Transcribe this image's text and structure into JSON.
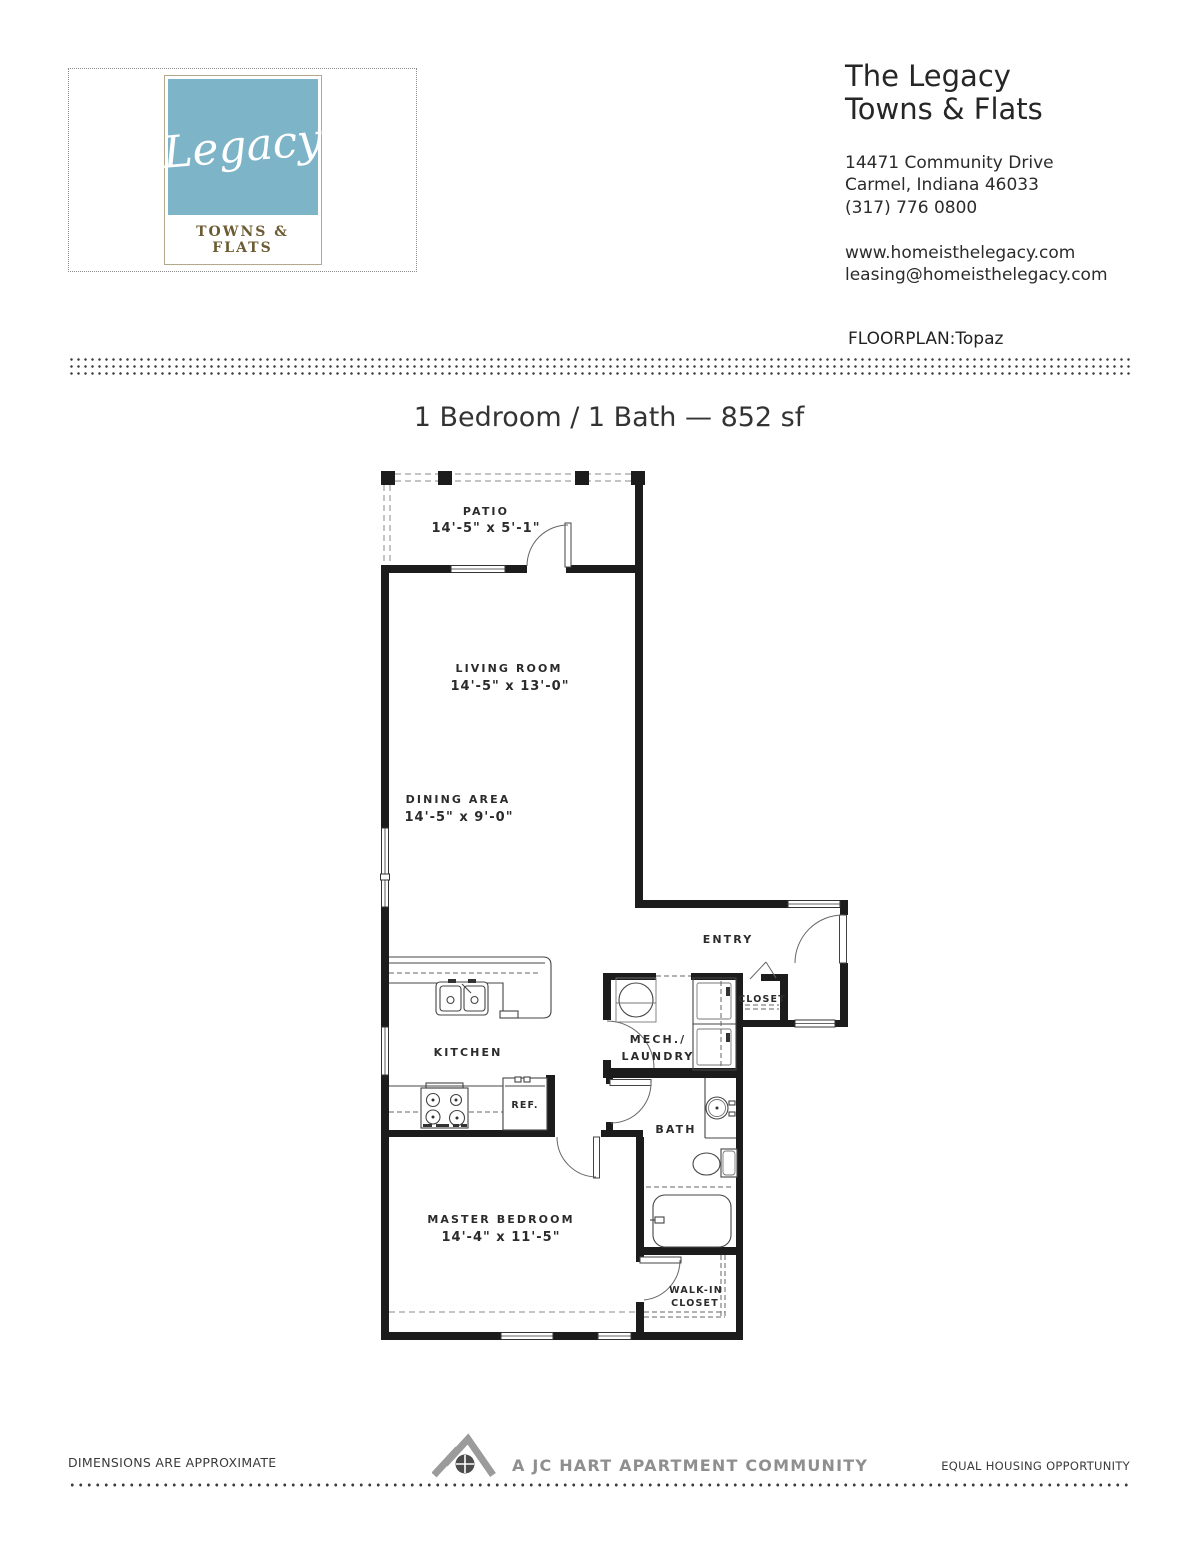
{
  "header": {
    "logo": {
      "script": "Legacy",
      "wordmark": "TOWNS & FLATS",
      "blue": "#7db4c8",
      "brown": "#6d5c33"
    },
    "company_line1": "The Legacy",
    "company_line2": "Towns & Flats",
    "address_line1": "14471 Community Drive",
    "address_line2": "Carmel, Indiana 46033",
    "phone": "(317) 776 0800",
    "website": "www.homeisthelegacy.com",
    "email": "leasing@homeisthelegacy.com",
    "floorplan": "FLOORPLAN:Topaz"
  },
  "plan": {
    "title": "1 Bedroom / 1 Bath — 852 sf",
    "labels": {
      "patio": "PATIO",
      "patio_dims": "14'-5\" x 5'-1\"",
      "living": "LIVING ROOM",
      "living_dims": "14'-5\" x 13'-0\"",
      "dining": "DINING AREA",
      "dining_dims": "14'-5\" x 9'-0\"",
      "entry": "ENTRY",
      "closet": "CLOSET",
      "mech_line1": "MECH./",
      "mech_line2": "LAUNDRY",
      "kitchen": "KITCHEN",
      "ref": "REF.",
      "bath": "BATH",
      "master": "MASTER BEDROOM",
      "master_dims": "14'-4\" x 11'-5\"",
      "walkin_line1": "WALK-IN",
      "walkin_line2": "CLOSET"
    }
  },
  "footer": {
    "dimensions_note": "DIMENSIONS ARE APPROXIMATE",
    "community": "A JC HART APARTMENT COMMUNITY",
    "equal_housing": "EQUAL HOUSING OPPORTUNITY"
  }
}
